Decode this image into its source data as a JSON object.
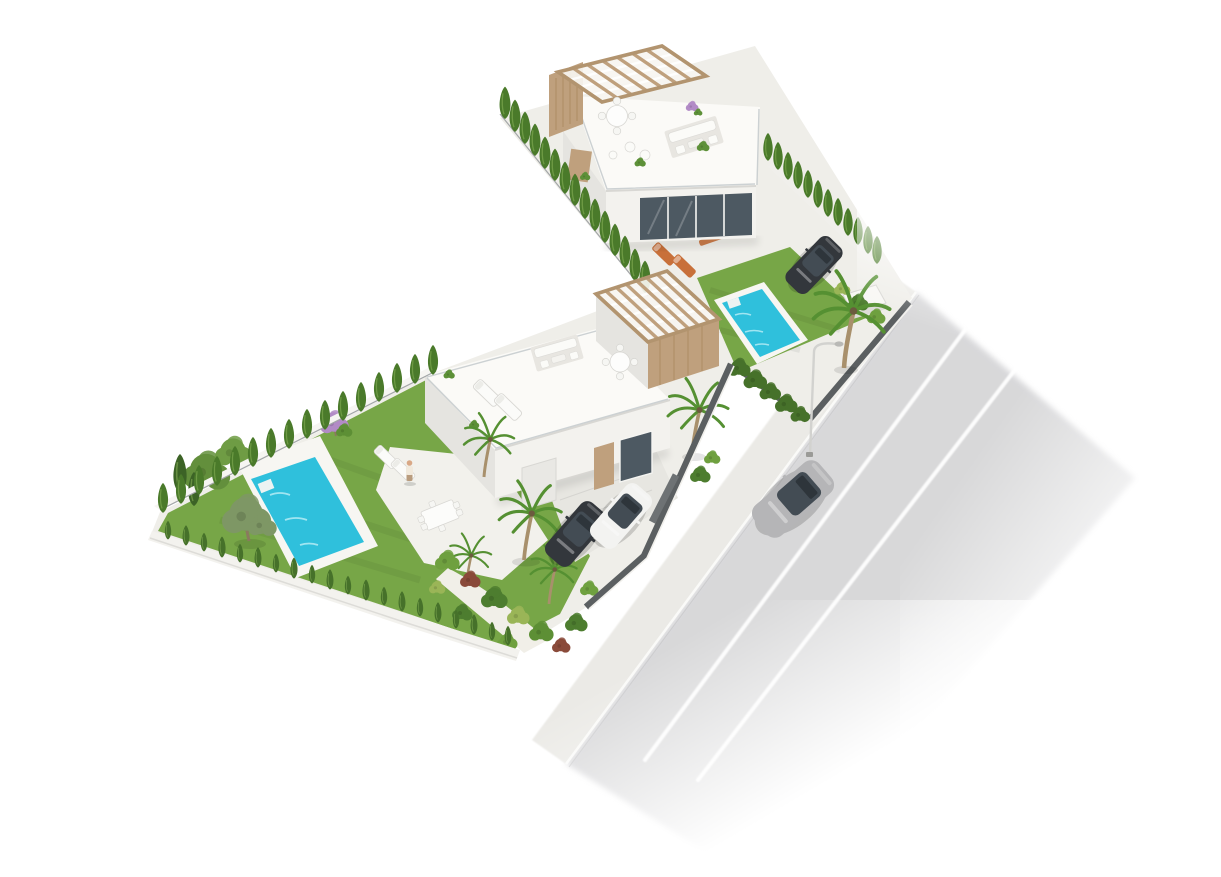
{
  "meta": {
    "title": "Aerial 3D architectural render: two modern villas with private pools beside a road",
    "type": "architectural-render",
    "has_text": false
  },
  "colors": {
    "background": "#ffffff",
    "paving": "#efeee9",
    "terrace": "#f2f1ec",
    "driveway": "#e7e6e1",
    "sidewalk": "#ebeae6",
    "road": "#d6d6d8",
    "lane_line": "#ffffff",
    "building_roof": "#fbfaf7",
    "building_face": "#f3f2ee",
    "building_shade": "#e5e4e0",
    "glass": "#4d5962",
    "wood": "#bfa07d",
    "grass": "#77a647",
    "cypress": "#4a7a2a",
    "hedge_dark": "#46712a",
    "palm": "#559032",
    "olive": "#7e9765",
    "purple": "#b28bc6",
    "pool_water": "#2fc0dc",
    "pool_deck": "#f7f6f2",
    "fence": "#5b5f61",
    "car_silver": "#b5b5b7",
    "car_dark": "#33373c",
    "car_white": "#f3f3f1",
    "furniture_orange": "#c8703a"
  },
  "scene": {
    "background": "#ffffff",
    "road": {
      "orientation": "diagonal, top-right to bottom-center",
      "lane_lines": 2,
      "moving_cars": 1,
      "street_lamps": 1
    },
    "pools": 2,
    "parked_cars": 3,
    "people": 1,
    "villas": [
      {
        "id": "villa-a",
        "position": "upper",
        "features": [
          "flat roof terrace",
          "wood pergola",
          "roof lounge and round dining table",
          "glass balustrade",
          "orange garden dining set",
          "orange sun loungers",
          "lawn with pool",
          "parked dark car",
          "cypress hedges",
          "palm tree",
          "white gate box"
        ]
      },
      {
        "id": "villa-b",
        "position": "lower-left",
        "features": [
          "flat roof terrace",
          "wood pergola",
          "white sun loungers",
          "outdoor sofa",
          "round roof table",
          "garden dining set",
          "person",
          "lawn with pool",
          "olive tree",
          "purple flowering tree",
          "palm trees",
          "tropical corner garden",
          "two parked cars",
          "cypress hedge",
          "dark street fence"
        ]
      }
    ]
  }
}
